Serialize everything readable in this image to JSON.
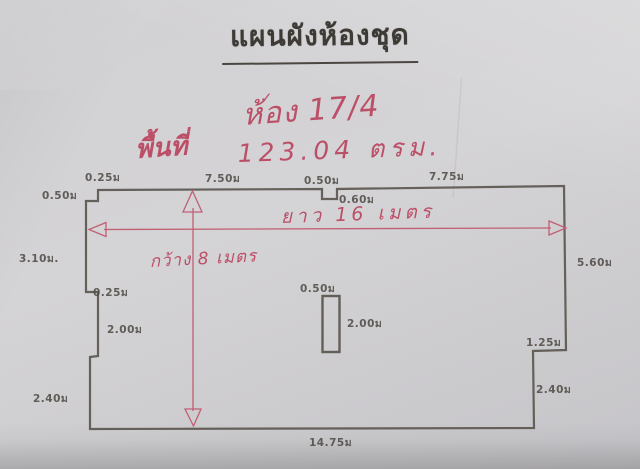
{
  "title": "แผนผังห้องชุด",
  "annotations": {
    "checkmark": "✓",
    "room_number": "ห้อง 17/4",
    "area_label": "พื้นที่",
    "area_value": "123.04 ตรม.",
    "length_note": "ยาว 16 เมตร",
    "width_note": "กว้าง 8 เมตร"
  },
  "dimensions": {
    "top_left_step_vertical": "0.50ม",
    "top_left_step_horizontal": "0.25ม",
    "top_left_segment": "7.50ม",
    "top_notch_width": "0.50ม",
    "top_notch_depth": "0.60ม",
    "top_right_segment": "7.75ม",
    "left_upper": "3.10ม.",
    "left_notch": "0.25ม",
    "left_middle": "2.00ม",
    "left_lower": "2.40ม",
    "right_side": "5.60ม",
    "right_step": "1.25ม",
    "right_lower": "2.40ม",
    "bottom": "14.75ม",
    "pillar_width": "0.50ม",
    "pillar_height": "2.00ม"
  },
  "colors": {
    "paper": "#d1d0d3",
    "ink": "#565149",
    "marker_red": "#bb4f68"
  }
}
